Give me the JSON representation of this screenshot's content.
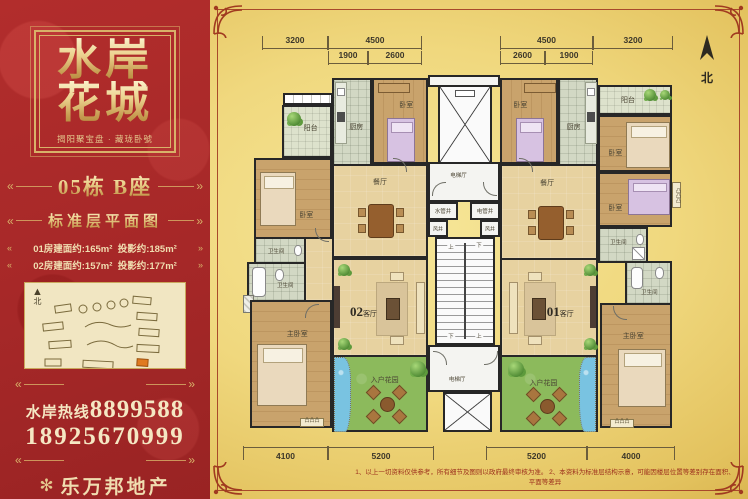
{
  "left_panel": {
    "title_line1": "水岸",
    "title_line2": "花城",
    "subtitle": "揭阳聚宝盘 · 藏珑卧號",
    "building": "05栋  B座",
    "plan_title": "标准层平面图",
    "area_01": "01房建面约:165m²",
    "proj_01": "投影约:185m²",
    "area_02": "02房建面约:157m²",
    "proj_02": "投影约:177m²",
    "sitemap_north": "北",
    "hotline_label": "水岸热线",
    "hotline_number": "8899588",
    "phone_number": "18925670999",
    "agency_name": "乐万邦地产"
  },
  "plan": {
    "north_label": "北",
    "rooms": {
      "balcony": "阳台",
      "kitchen": "厨房",
      "bedroom": "卧室",
      "dining": "餐厅",
      "bath": "卫生间",
      "master": "主卧室",
      "garden": "入户花园"
    },
    "units": {
      "left_num": "02",
      "right_num": "01",
      "living_suffix": "客厅"
    },
    "core": {
      "elevator_hall": "电梯厅",
      "water_shaft": "水管井",
      "elec_shaft": "电管井",
      "air_shaft": "风井",
      "up": "上",
      "down": "下"
    },
    "ac_marker": "凸凸凸",
    "dims_top": [
      "3200",
      "4500",
      "4500",
      "3200"
    ],
    "dims_top_sub": [
      "1900",
      "2600",
      "2600",
      "1900"
    ],
    "dims_bottom": [
      "4100",
      "5200",
      "5200",
      "4000"
    ],
    "footnote": "1、以上一切资料仅供参考，所有细节及图则以政府最终审核为准。  2、本资料为标准层结构示意，可能因楼层位置等差别存在面积、平面等差异"
  },
  "colors": {
    "panel_red": "#a62828",
    "gold": "#d8b269",
    "plan_wall": "#272727",
    "garden_green": "#8cba5c",
    "water_blue": "#79c3e1"
  }
}
